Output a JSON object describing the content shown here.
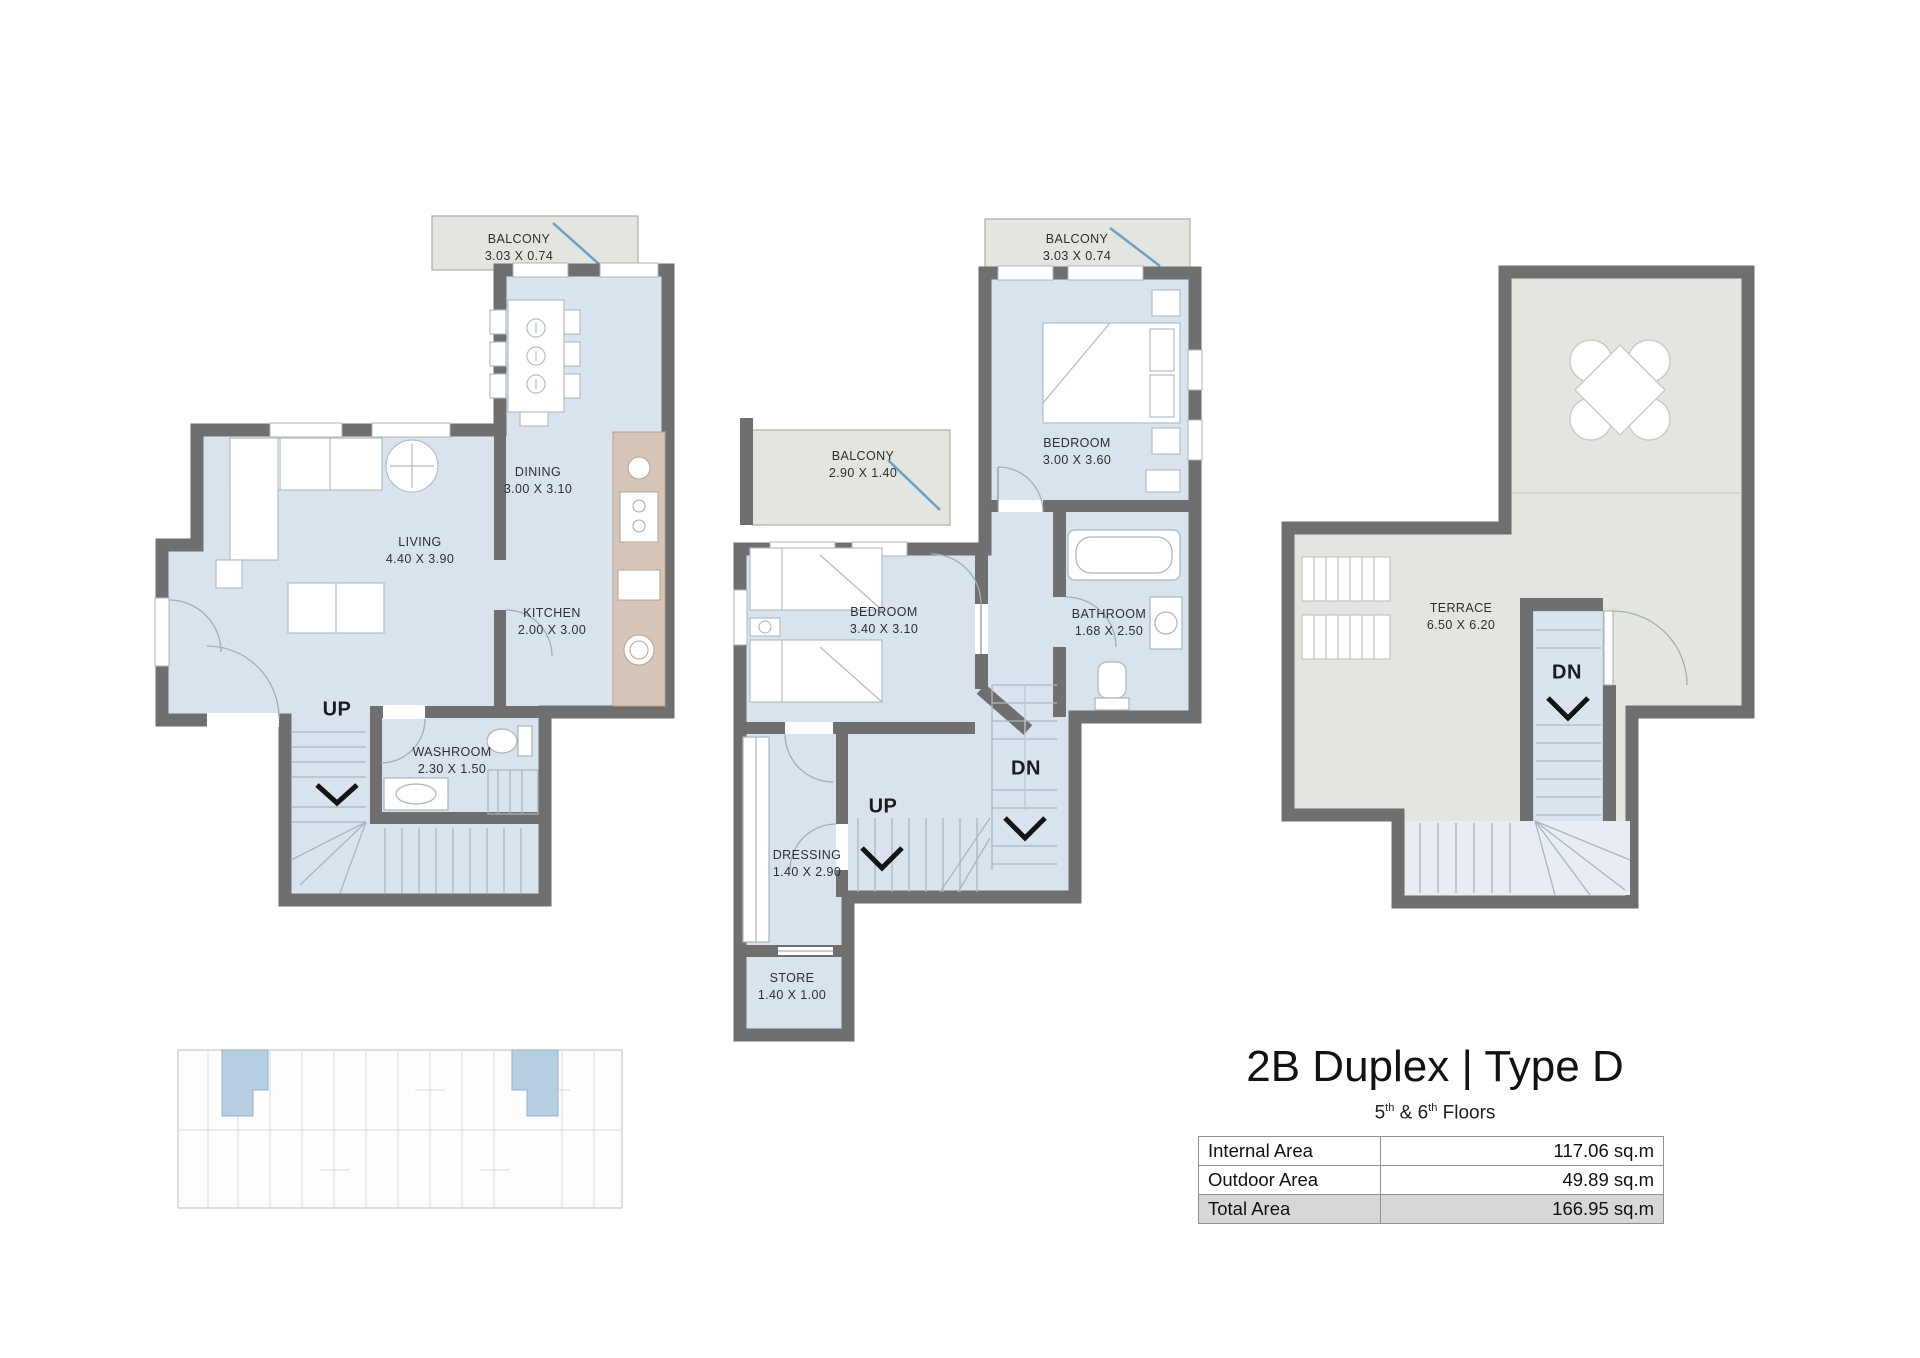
{
  "header": {
    "title": "2B Duplex | Type D",
    "floors_prefix": "5",
    "floors_sup1": "th",
    "floors_mid": " & 6",
    "floors_sup2": "th",
    "floors_suffix": " Floors"
  },
  "area_table": {
    "internal": {
      "label": "Internal Area",
      "value": "117.06 sq.m"
    },
    "outdoor": {
      "label": "Outdoor Area",
      "value": "49.89 sq.m"
    },
    "total": {
      "label": "Total Area",
      "value": "166.95 sq.m"
    }
  },
  "lower_floor": {
    "balcony": {
      "name": "BALCONY",
      "dims": "3.03 X 0.74"
    },
    "dining": {
      "name": "DINING",
      "dims": "3.00 X 3.10"
    },
    "living": {
      "name": "LIVING",
      "dims": "4.40 X 3.90"
    },
    "kitchen": {
      "name": "KITCHEN",
      "dims": "2.00 X 3.00"
    },
    "washroom": {
      "name": "WASHROOM",
      "dims": "2.30 X 1.50"
    },
    "stairs_up": "UP"
  },
  "upper_floor": {
    "balcony_top": {
      "name": "BALCONY",
      "dims": "3.03 X 0.74"
    },
    "bedroom_top": {
      "name": "BEDROOM",
      "dims": "3.00 X 3.60"
    },
    "balcony_side": {
      "name": "BALCONY",
      "dims": "2.90 X 1.40"
    },
    "bedroom_side": {
      "name": "BEDROOM",
      "dims": "3.40 X 3.10"
    },
    "bathroom": {
      "name": "BATHROOM",
      "dims": "1.68 X 2.50"
    },
    "dressing": {
      "name": "DRESSING",
      "dims": "1.40 X 2.90"
    },
    "store": {
      "name": "STORE",
      "dims": "1.40 X 1.00"
    },
    "stairs_up": "UP",
    "stairs_down": "DN"
  },
  "roof_floor": {
    "terrace": {
      "name": "TERRACE",
      "dims": "6.50 X 6.20"
    },
    "stairs_down": "DN"
  },
  "colors": {
    "wall": "#6f6f6f",
    "room_fill": "#d9e3ed",
    "outdoor_fill": "#e2e6de",
    "stair_fill": "#e3ebf2",
    "counter_fill": "#d7c6b8",
    "balcony_door": "#6f9fc8",
    "keyplan_highlight": "#b7cfe3",
    "total_row_bg": "#d7d7d7"
  }
}
